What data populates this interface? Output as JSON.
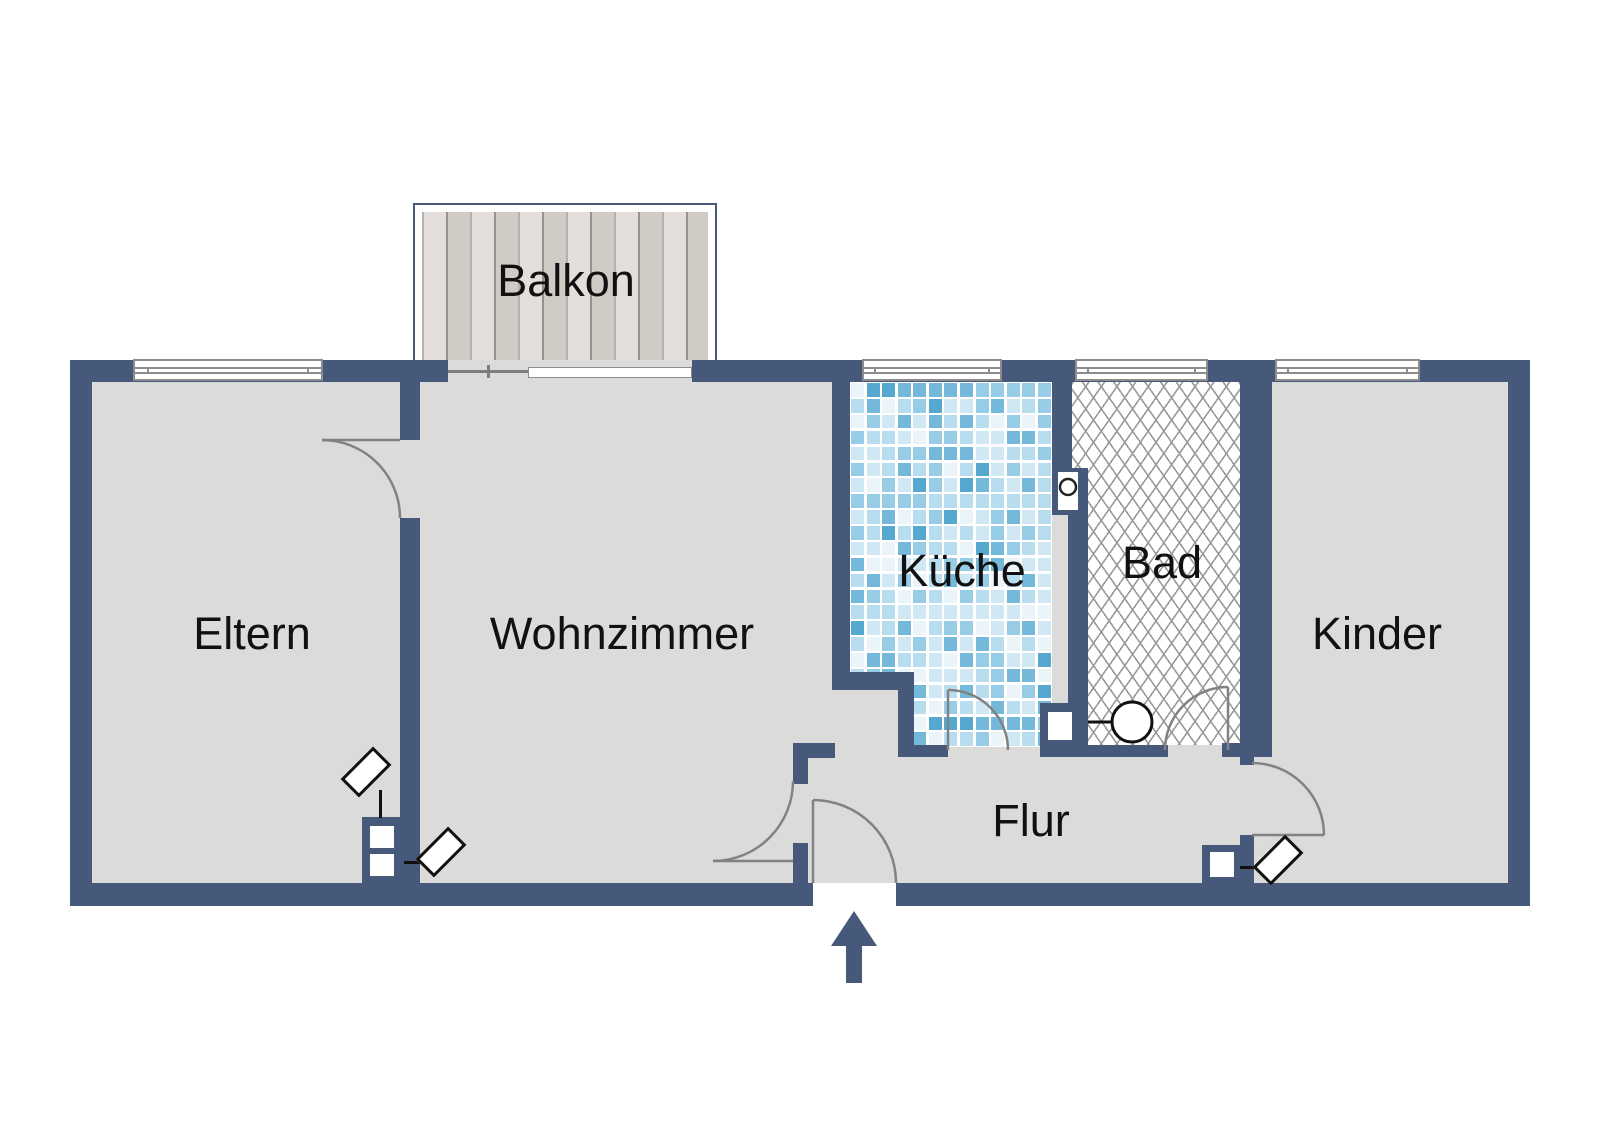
{
  "plan": {
    "type": "apartment-floor-plan",
    "rooms": [
      {
        "id": "balkon",
        "label": "Balkon"
      },
      {
        "id": "eltern",
        "label": "Eltern"
      },
      {
        "id": "wohnzimmer",
        "label": "Wohnzimmer"
      },
      {
        "id": "kueche",
        "label": "Küche"
      },
      {
        "id": "bad",
        "label": "Bad"
      },
      {
        "id": "kinder",
        "label": "Kinder"
      },
      {
        "id": "flur",
        "label": "Flur"
      }
    ],
    "entrance": {
      "arrow_direction": "up"
    },
    "fixtures": [
      "entrance-arrow-icon",
      "washbasin-icon",
      "pipe-shaft-icon",
      "wall-socket-icon",
      "light-switch-icon",
      "door-swing-arc",
      "window-glyph",
      "balcony-plank-floor",
      "kitchen-tile-floor",
      "bath-lattice-floor"
    ],
    "colors": {
      "wall": "#46597a",
      "floor": "#dbdbda",
      "door_arc": "#828282",
      "window_border": "#8c8c8c",
      "lattice_line": "#9a9a9a",
      "balcony_plank": "#d8d2cd",
      "balcony_plank_line": "#9a938e",
      "fixture_outline": "#111111",
      "kitchen_tile_palette": [
        "#eaf4f9",
        "#cfe8f4",
        "#b7ddef",
        "#97cce6",
        "#74b9da",
        "#57a8ce"
      ]
    },
    "kitchen_tile_grid": {
      "cols": 13,
      "rows": 23
    }
  }
}
